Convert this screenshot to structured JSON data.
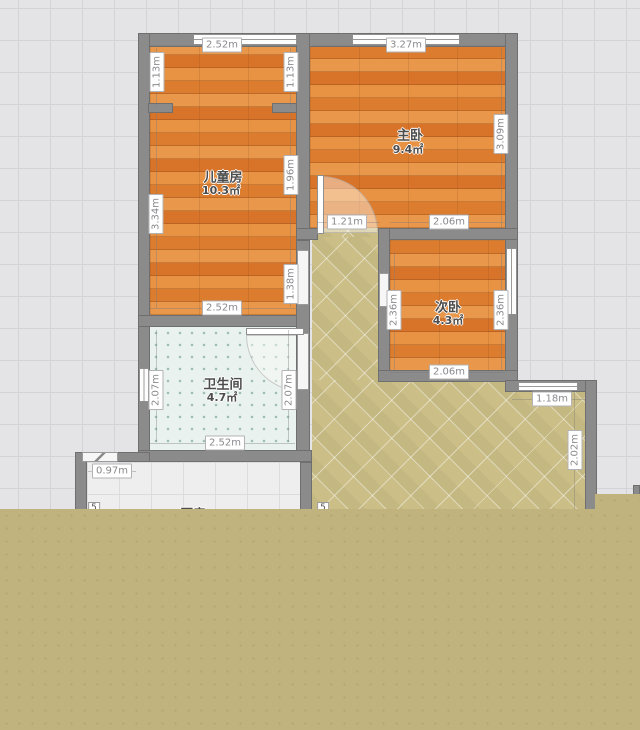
{
  "rooms": {
    "children": {
      "name": "儿童房",
      "area": "10.3㎡"
    },
    "master": {
      "name": "主卧",
      "area": "9.4㎡"
    },
    "second": {
      "name": "次卧",
      "area": "4.3㎡"
    },
    "bath": {
      "name": "卫生间",
      "area": "4.7㎡"
    },
    "kitchen": {
      "name": "厨房"
    }
  },
  "dims": {
    "child_top": "2.52m",
    "child_bottom": "2.52m",
    "child_left_upper": "1.13m",
    "child_right_upper": "1.13m",
    "child_left": "3.34m",
    "child_right_mid": "1.96m",
    "child_right_low": "1.38m",
    "master_top": "3.27m",
    "master_right": "3.09m",
    "hall_passage": "1.21m",
    "second_top": "2.06m",
    "second_bottom": "2.06m",
    "second_left": "2.36m",
    "second_right": "2.36m",
    "bath_left": "2.07m",
    "bath_right": "2.07m",
    "bath_bottom": "2.52m",
    "kitchen_door": "0.97m",
    "balcony_top": "1.18m",
    "balcony_right": "2.02m"
  },
  "markers": {
    "m1": "5",
    "m2": "5"
  },
  "colors": {
    "wall": "#8b8b8c",
    "wood_floor": "#df8233",
    "hall_tile": "#cbbe87",
    "bath_tile": "#e9f2ee",
    "kitchen_tile": "#eeeeef",
    "background": "#e4e4e6",
    "bottom_overlay": "#c1b37d"
  }
}
